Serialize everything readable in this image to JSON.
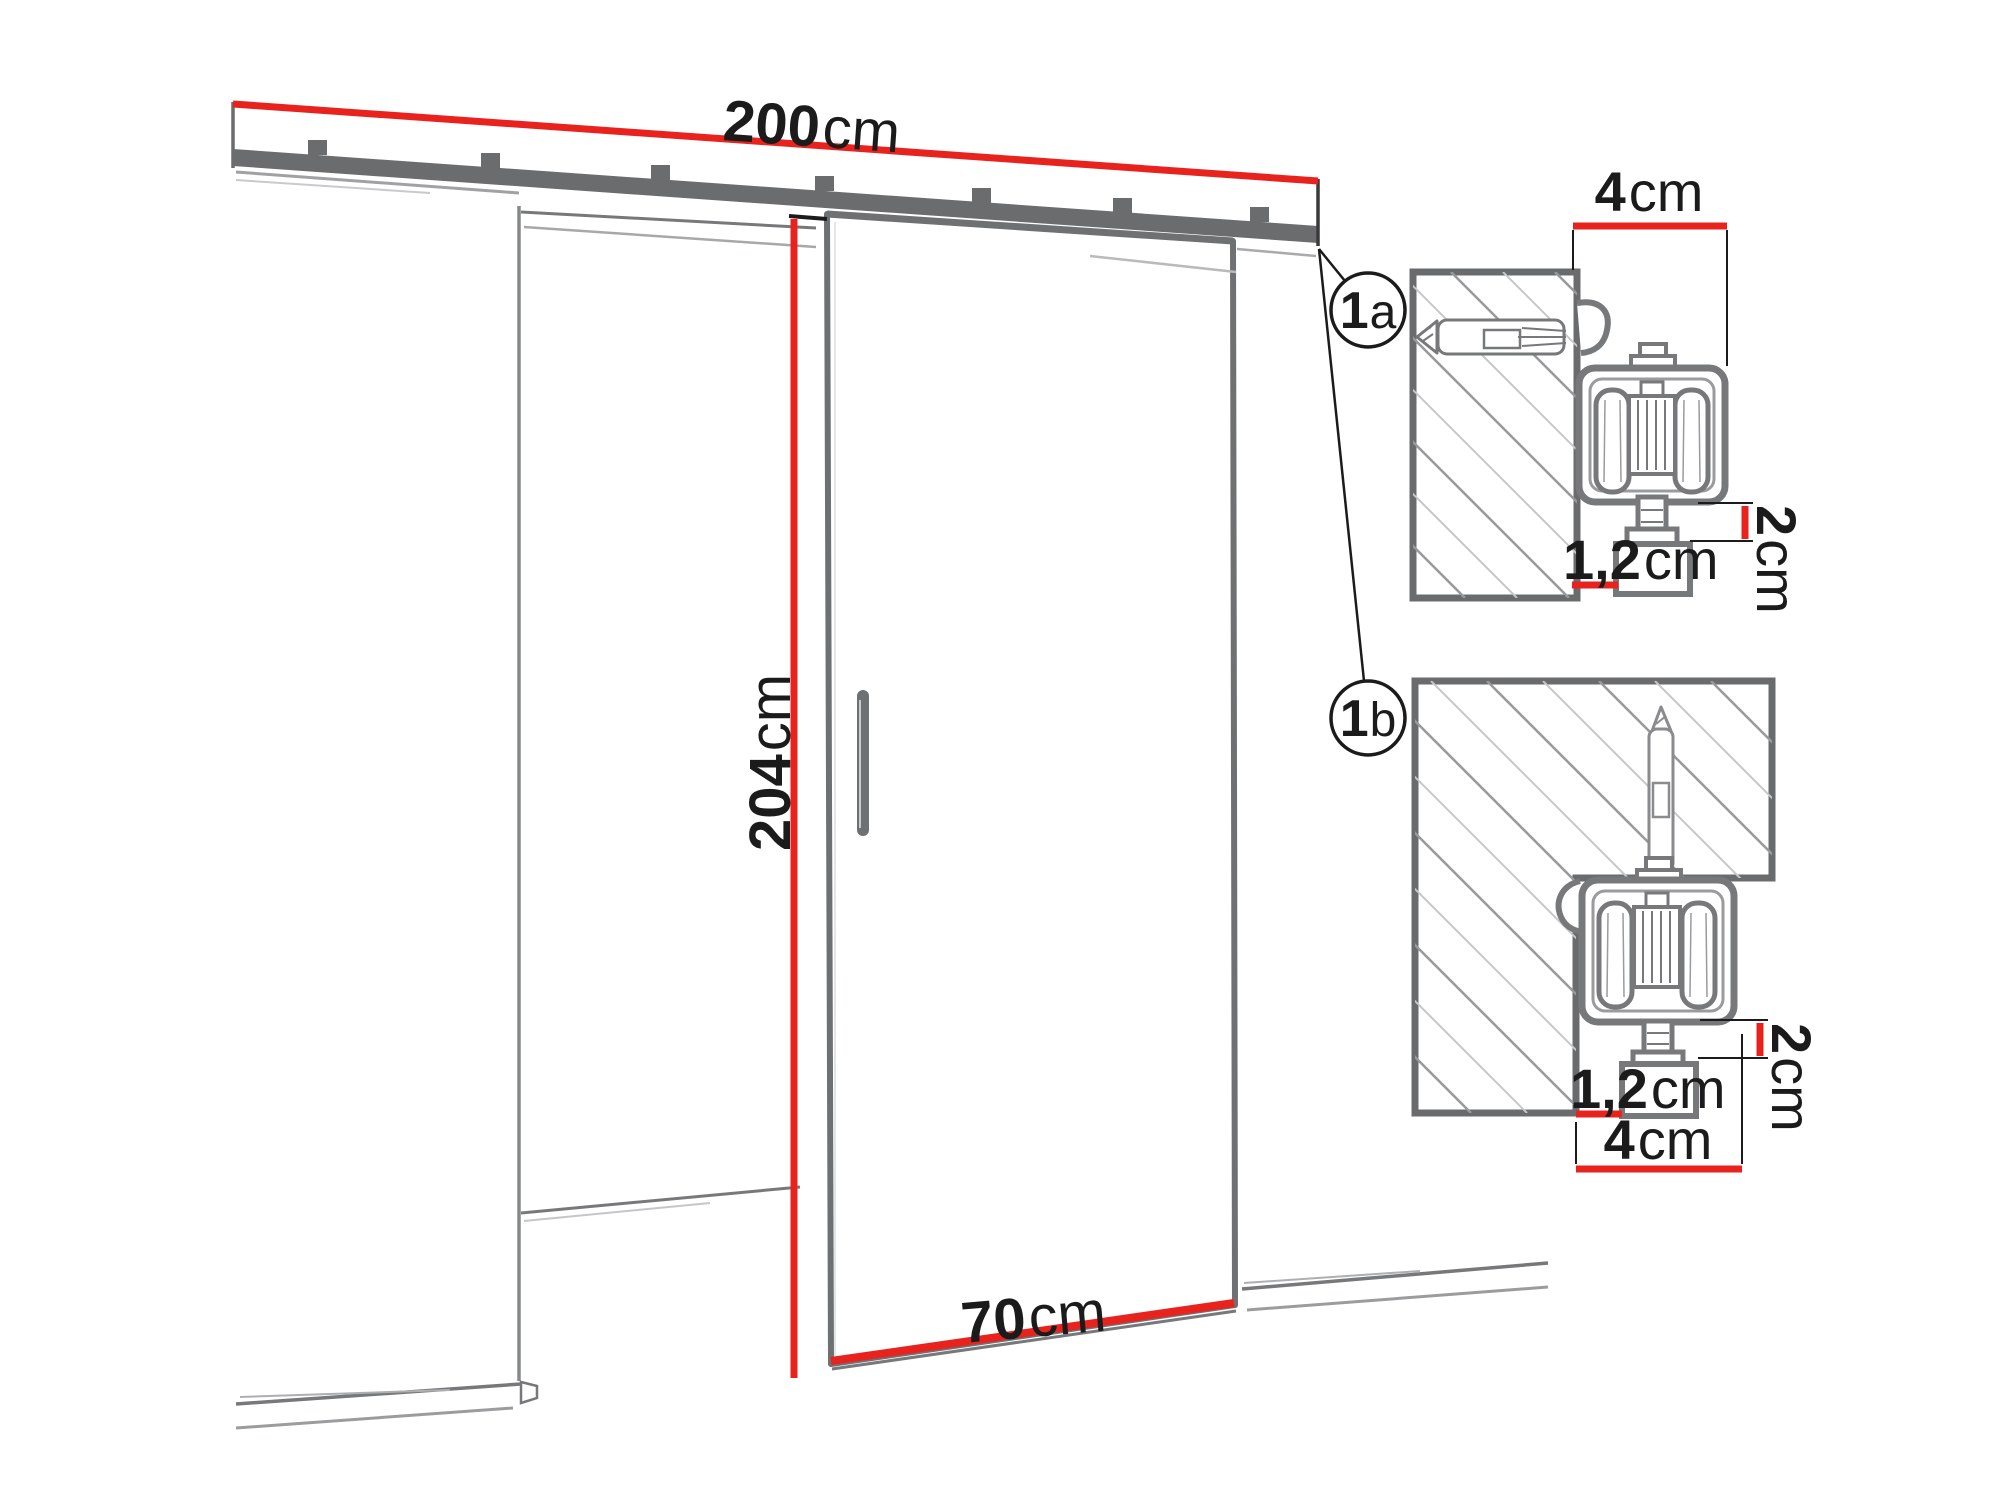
{
  "colors": {
    "red": "#e8231e",
    "outline_dark": "#6b6c6e",
    "outline_mid": "#77787a",
    "outline_light": "#9b9c9e",
    "text": "#1b1b1b",
    "hatch_dark": "#98999b",
    "hatch_light": "#c6c7c8"
  },
  "main_view": {
    "rail_dimension": {
      "value": "200",
      "unit": "cm"
    },
    "height_dimension": {
      "value": "204",
      "unit": "cm"
    },
    "door_width_dimension": {
      "value": "70",
      "unit": "cm"
    }
  },
  "callouts": {
    "a": {
      "digit": "1",
      "letter": "a"
    },
    "b": {
      "digit": "1",
      "letter": "b"
    }
  },
  "detail_a": {
    "track_width": {
      "value": "4",
      "unit": "cm"
    },
    "clearance": {
      "value": "1,2",
      "unit": "cm"
    },
    "drop": {
      "value": "2",
      "unit": "cm"
    }
  },
  "detail_b": {
    "track_width": {
      "value": "4",
      "unit": "cm"
    },
    "clearance": {
      "value": "1,2",
      "unit": "cm"
    },
    "drop": {
      "value": "2",
      "unit": "cm"
    }
  }
}
